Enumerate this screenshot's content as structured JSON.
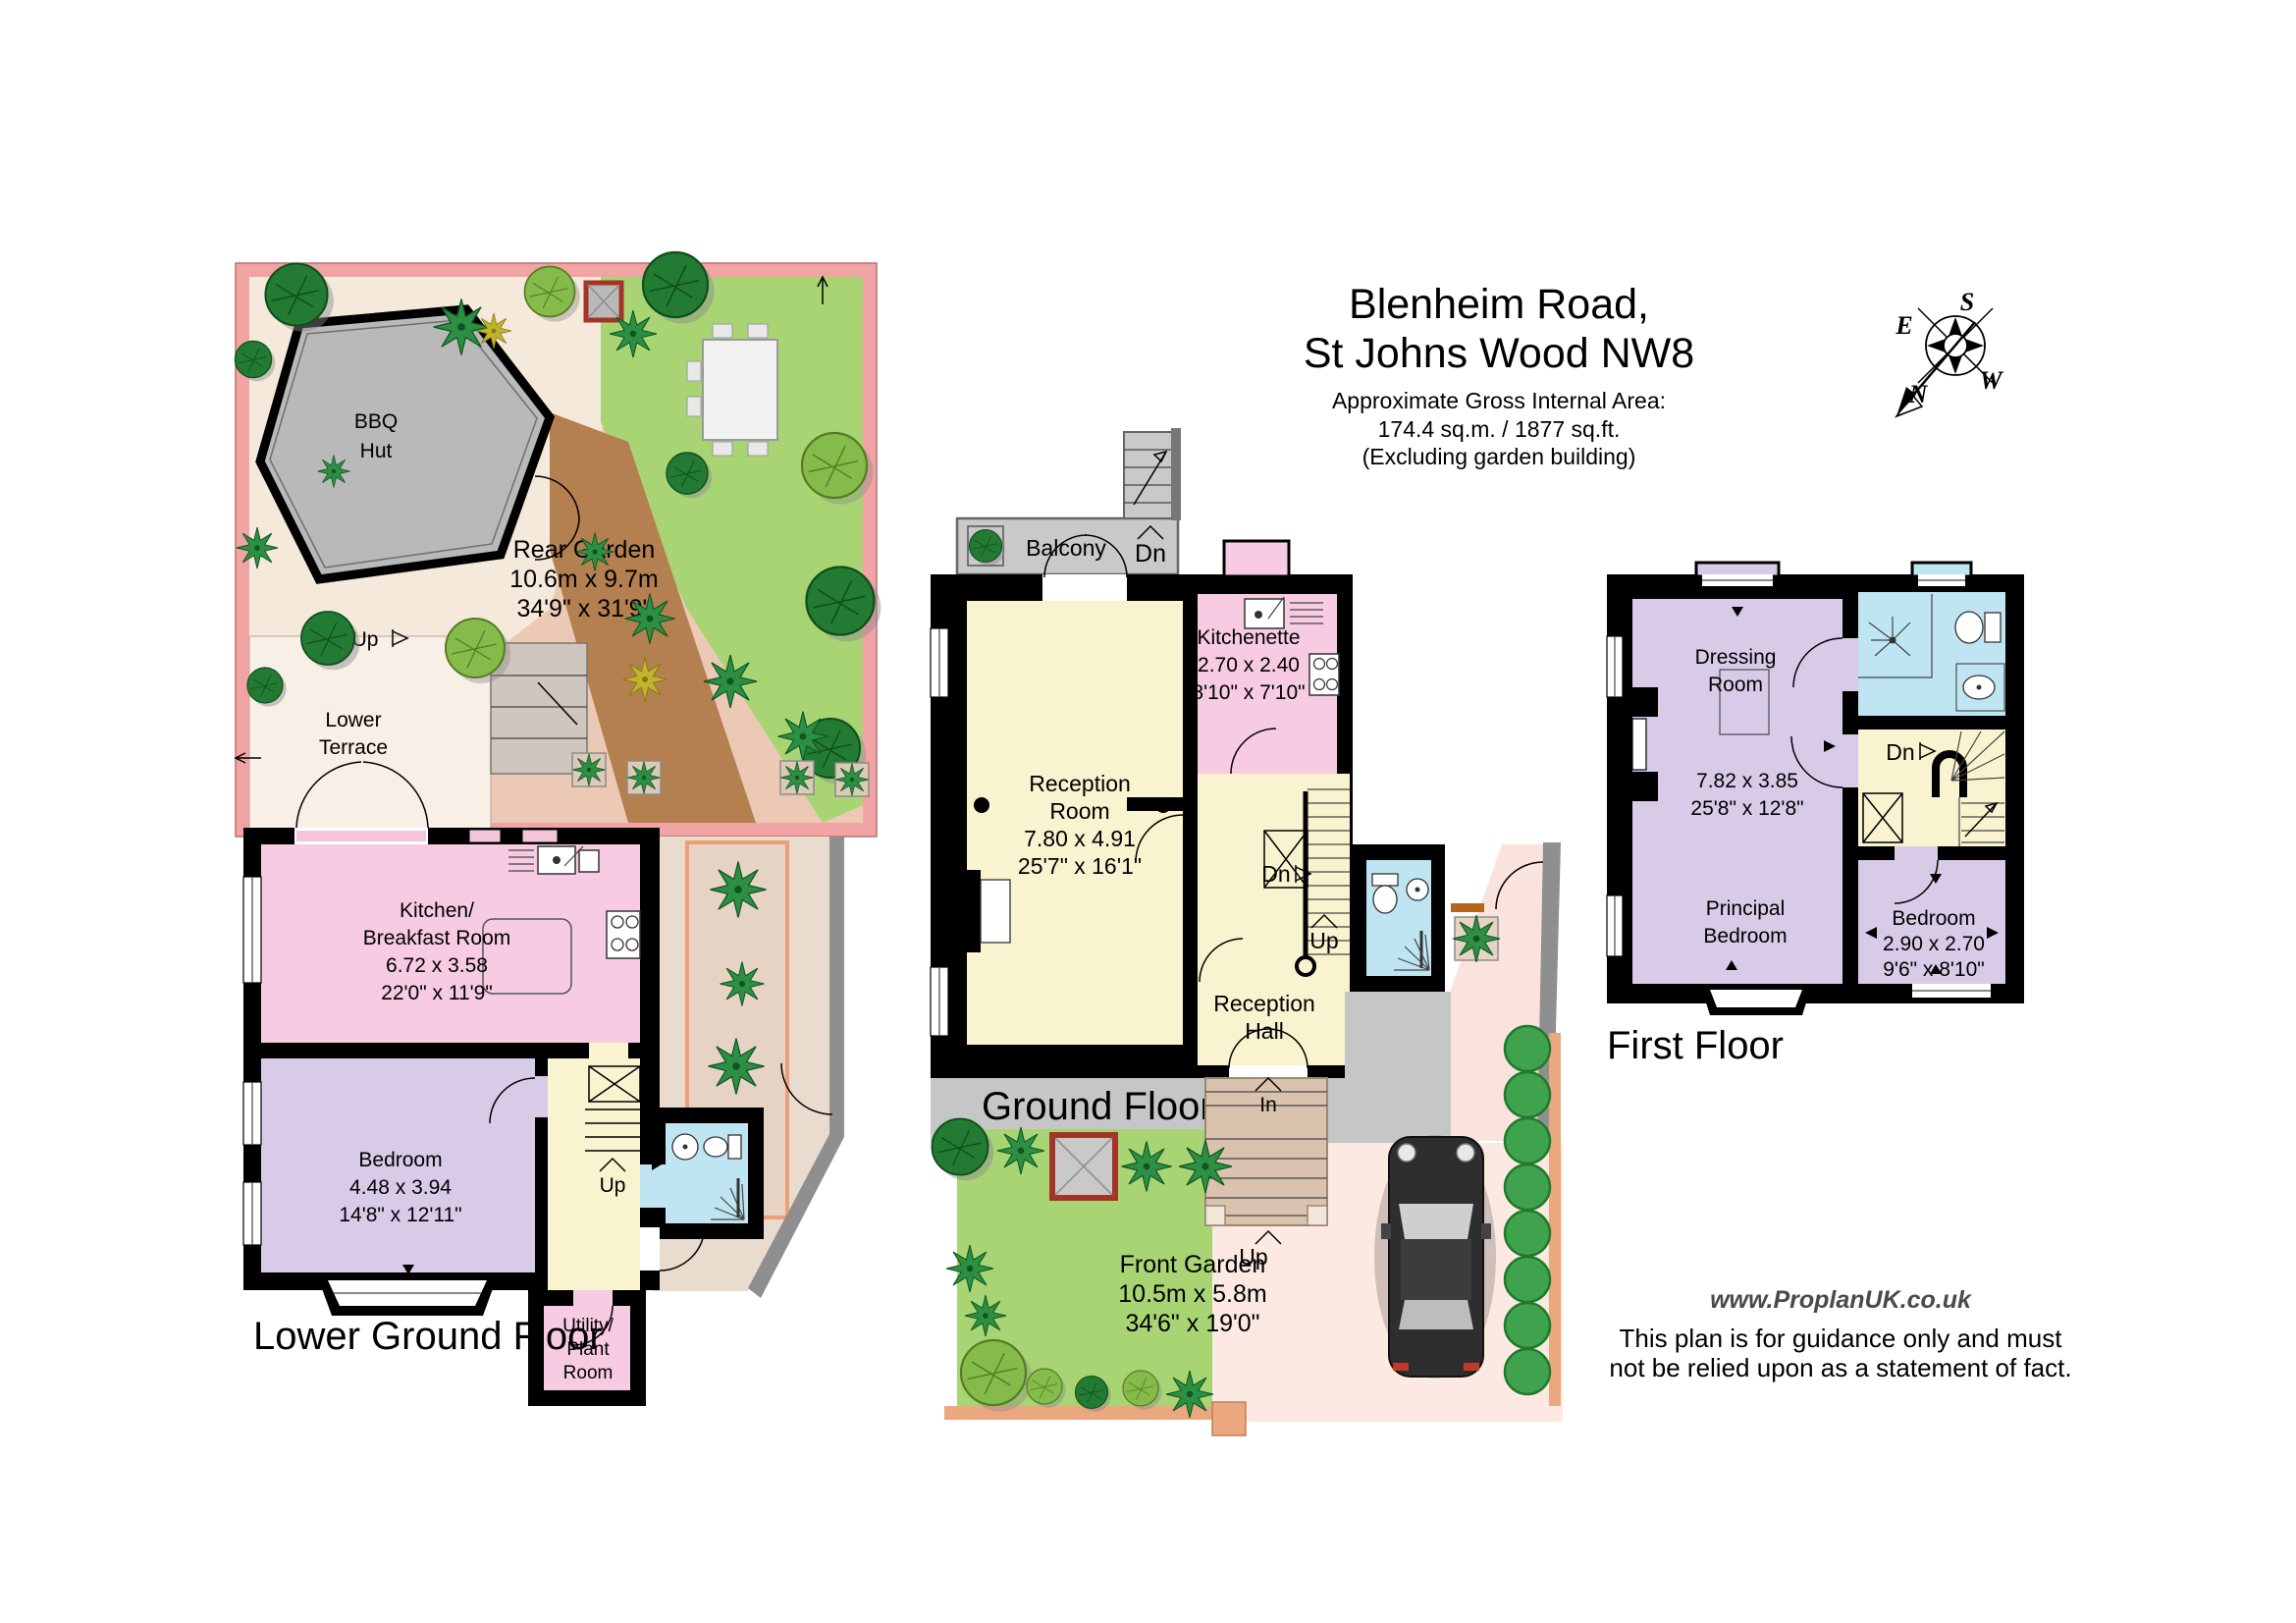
{
  "title": {
    "line1": "Blenheim Road,",
    "line2": "St Johns Wood NW8",
    "area_label": "Approximate Gross Internal Area:",
    "area_value": "174.4 sq.m. / 1877 sq.ft.",
    "area_note": "(Excluding garden building)"
  },
  "compass": {
    "n": "N",
    "s": "S",
    "e": "E",
    "w": "W"
  },
  "lower_ground": {
    "floor_label": "Lower Ground Floor",
    "bbq_hut": {
      "l1": "BBQ",
      "l2": "Hut"
    },
    "rear_garden": {
      "name": "Rear Garden",
      "dim_m": "10.6m x 9.7m",
      "dim_ft": "34'9\" x 31'9\""
    },
    "lower_terrace": {
      "l1": "Lower",
      "l2": "Terrace"
    },
    "garden_up": "Up",
    "kitchen": {
      "l1": "Kitchen/",
      "l2": "Breakfast Room",
      "dim_m": "6.72 x 3.58",
      "dim_ft": "22'0\" x 11'9\""
    },
    "bedroom": {
      "name": "Bedroom",
      "dim_m": "4.48 x 3.94",
      "dim_ft": "14'8\" x 12'11\""
    },
    "utility": {
      "l1": "Utility/",
      "l2": "Plant",
      "l3": "Room"
    },
    "stairs_up": "Up"
  },
  "ground": {
    "floor_label": "Ground Floor",
    "balcony": {
      "name": "Balcony",
      "dn": "Dn"
    },
    "reception_room": {
      "l1": "Reception",
      "l2": "Room",
      "dim_m": "7.80 x 4.91",
      "dim_ft": "25'7\" x 16'1\""
    },
    "kitchenette": {
      "name": "Kitchenette",
      "dim_m": "2.70 x 2.40",
      "dim_ft": "8'10\" x 7'10\""
    },
    "reception_hall": {
      "l1": "Reception",
      "l2": "Hall"
    },
    "stairs": {
      "dn": "Dn",
      "up": "Up"
    },
    "entrance": {
      "in_label": "In",
      "up_label": "Up"
    },
    "front_garden": {
      "name": "Front Garden",
      "dim_m": "10.5m x 5.8m",
      "dim_ft": "34'6\" x 19'0\""
    }
  },
  "first": {
    "floor_label": "First Floor",
    "dressing_room": {
      "l1": "Dressing",
      "l2": "Room"
    },
    "suite_dims": {
      "dim_m": "7.82 x 3.85",
      "dim_ft": "25'8\" x 12'8\""
    },
    "principal_bedroom": {
      "l1": "Principal",
      "l2": "Bedroom"
    },
    "bedroom": {
      "name": "Bedroom",
      "dim_m": "2.90 x 2.70",
      "dim_ft": "9'6\" x 8'10\""
    },
    "stairs_dn": "Dn"
  },
  "footer": {
    "website": "www.ProplanUK.co.uk",
    "disclaimer_1": "This plan is for guidance only and must",
    "disclaimer_2": "not be relied upon as a statement of fact."
  },
  "colors": {
    "wall": "#000000",
    "room_pink": "#f7cbe2",
    "room_lavender": "#d8cbe8",
    "room_cream": "#faf3d0",
    "room_blue": "#bfe4f2",
    "balcony_grey": "#c9c9c9",
    "pavement_grey": "#c6c6c6",
    "lawn_green": "#a8d474",
    "garden_wall_pink": "#f2a3a3",
    "path_brown": "#b5804f",
    "hedge_green": "#3fa34d",
    "car_body": "#2e2e2e"
  }
}
